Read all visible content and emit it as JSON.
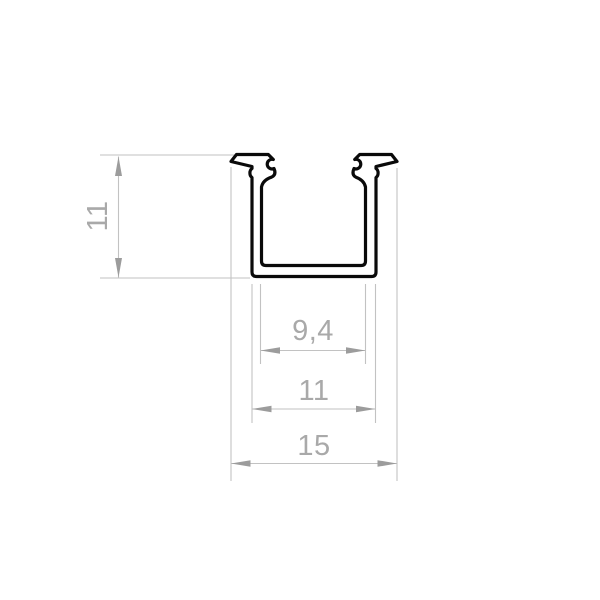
{
  "drawing": {
    "title": "U-channel profile cross-section technical drawing",
    "dimensions": {
      "height_label": "11",
      "inner_width_label": "9,4",
      "outer_width_label": "11",
      "overall_width_label": "15"
    },
    "dimension_values": {
      "height": 11,
      "inner_width": 9.4,
      "outer_width": 11,
      "overall_width": 15
    },
    "colors": {
      "background": "#ffffff",
      "profile_outline": "#0a0a0a",
      "dimension_lines": "#c2c2c2",
      "arrows": "#9c9c9c",
      "dimension_text": "#a9a9a9"
    }
  }
}
